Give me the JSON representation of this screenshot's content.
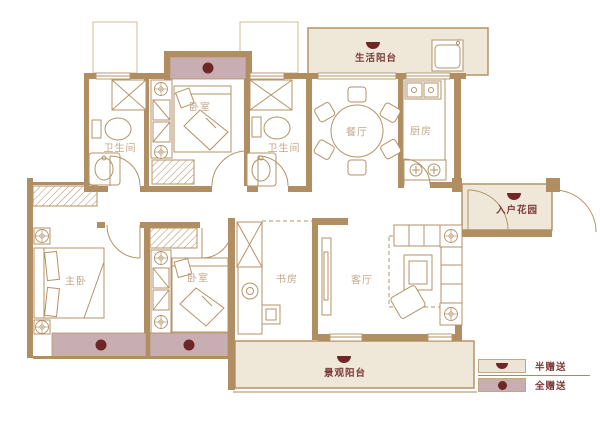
{
  "rooms": {
    "life_balcony": "生活阳台",
    "dining_room": "餐厅",
    "kitchen": "厨房",
    "bathroom_1": "卫生间",
    "bedroom_1": "卧室",
    "bathroom_2": "卫生间",
    "entry_garden": "入户花园",
    "master_bedroom": "主卧",
    "bedroom_2": "卧室",
    "study": "书房",
    "living_room": "客厅",
    "view_balcony": "景观阳台"
  },
  "legend": {
    "half_gift": "半赠送",
    "full_gift": "全赠送"
  },
  "colors": {
    "wall": "#b18e62",
    "furniture_line": "#b39368",
    "beige_fill": "#efe7d8",
    "mauve_fill": "#c8aeb2",
    "gift_symbol_red": "#6f2626",
    "room_label": "#c4a88a",
    "accent_label": "#7c3b3b"
  }
}
